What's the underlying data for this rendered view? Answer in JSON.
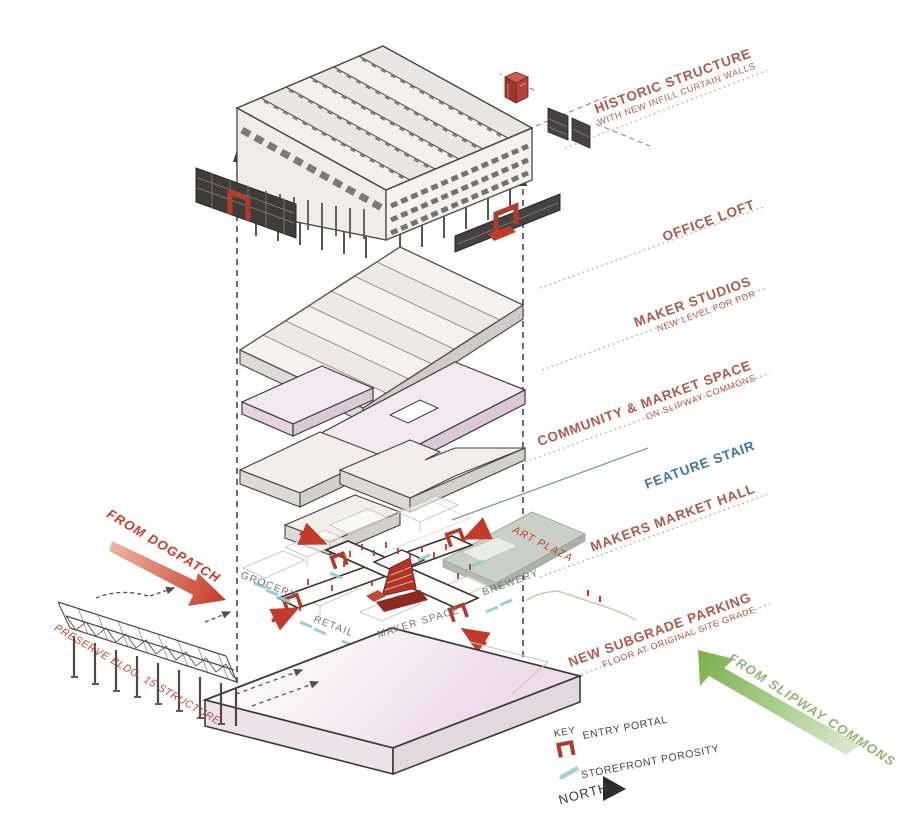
{
  "diagram_title": "Exploded axonometric building program diagram",
  "levels": [
    {
      "title": "HISTORIC STRUCTURE",
      "subtitle": "WITH NEW INFILL CURTAIN WALLS"
    },
    {
      "title": "OFFICE LOFT"
    },
    {
      "title": "MAKER STUDIOS",
      "subtitle": "NEW LEVEL FOR PDR"
    },
    {
      "title": "COMMUNITY & MARKET SPACE",
      "subtitle": "ON SLIPWAY COMMONS"
    },
    {
      "title": "FEATURE STAIR"
    },
    {
      "title": "MAKERS MARKET HALL"
    },
    {
      "title": "NEW SUBGRADE PARKING",
      "subtitle": "FLOOR AT ORIGINAL SITE GRADE"
    }
  ],
  "annotations": {
    "from_dogpatch": "FROM DOGPATCH",
    "preserve_bldg": "PRESERVE BLDG. 15 STRUCTURE",
    "from_slipway": "FROM SLIPWAY COMMONS"
  },
  "plan": {
    "grocery": "GROCERY",
    "retail": "RETAIL",
    "maker_space": "MAKER SPACE",
    "brewery": "BREWERY",
    "art_plaza": "ART PLAZA"
  },
  "legend": {
    "key": "KEY",
    "entry_portal": "ENTRY PORTAL",
    "storefront_porosity": "STOREFRONT POROSITY",
    "north": "NORTH"
  },
  "colors": {
    "label_rust": "#ae5a49",
    "accent_red": "#c23b2a",
    "portal_red": "#b23a2b",
    "feature_stair_blue": "#41789f",
    "porosity_teal": "#8fd0c9",
    "slipway_green": "#7ab14a",
    "plaza_green_gray": "#c9d0c5",
    "community_pink": "#f4e9f1",
    "ink": "#3e3a37"
  }
}
